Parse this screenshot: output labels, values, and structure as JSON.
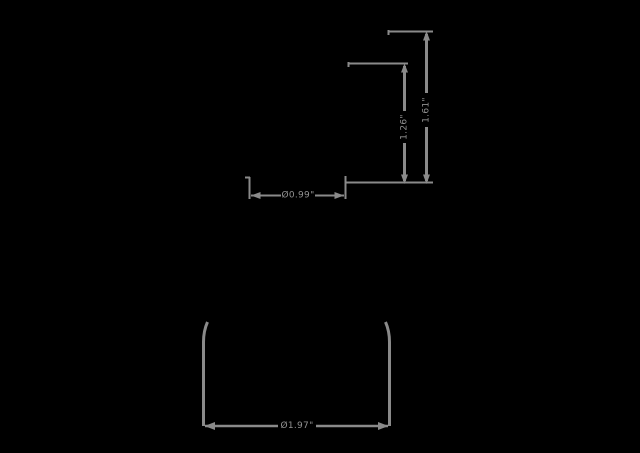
{
  "colors": {
    "background": "#000000",
    "line": "#8a8a8a",
    "label_text": "#919191"
  },
  "diagram": {
    "type": "dimension-drawing",
    "views": [
      {
        "name": "side-view",
        "description": "upper drawing with height and top diameter dimensions"
      },
      {
        "name": "top-view",
        "description": "lower drawing with base diameter dimension"
      }
    ],
    "dimensions": {
      "overall_height": "1.61\"",
      "upper_height": "1.26\"",
      "top_diameter": "Ø0.99\"",
      "base_diameter": "Ø1.97\""
    }
  }
}
